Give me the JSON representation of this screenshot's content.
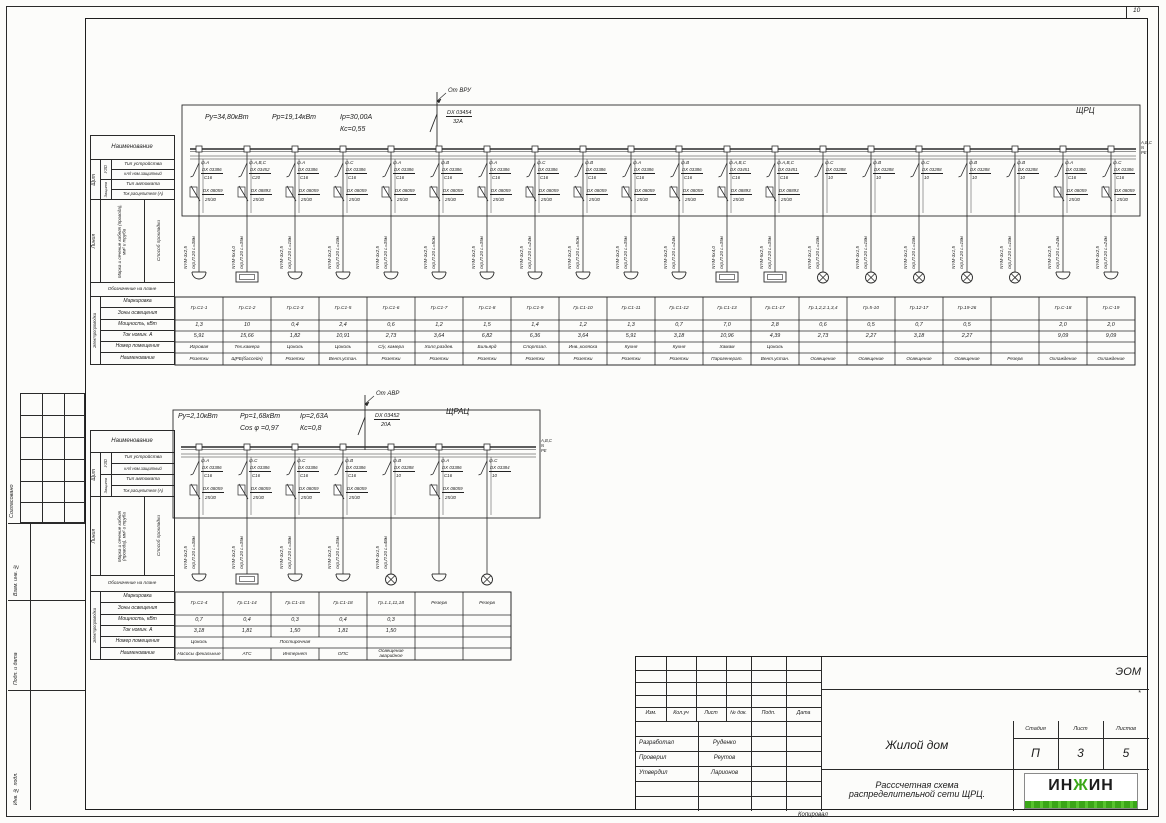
{
  "frame": {
    "zone_number": "10",
    "copied_label": "Копировал",
    "side_labels": [
      "Согласовано",
      "Взам. инв. №",
      "Подп. и дата",
      "Инв. № подл."
    ]
  },
  "colors": {
    "accent_green": "#3aa617",
    "line": "#2a2a2a"
  },
  "row_headers": {
    "name": "Наименование",
    "board": "Щит",
    "uzo": "УЗО",
    "protection": "Защита",
    "device_type": "Тип устройства",
    "ka_rating": "кА/I ном.защитный",
    "breaker_type": "Тип автомата",
    "trip_current": "Ток расцепителя (А)",
    "line": "Линия",
    "cable_mark": "Марка и сечение кабеля (провода), мм² и труба",
    "laying_method": "Способ прокладки",
    "plan_symbol": "Обозначение на плане",
    "wiring": "Электропроводка",
    "marking": "Маркировка",
    "lighting_zones": "Зоны освещения",
    "power": "Мощность, кВт",
    "current": "Ток номин. А",
    "room_number": "Номер помещения",
    "name2": "Наименование"
  },
  "panel1": {
    "title": "ЩРЦ",
    "source": "От ВРУ",
    "incoming_device": "DX  03454",
    "incoming_rating": "32А",
    "params_row1": [
      "Ру=34,80кВт",
      "Рр=19,14кВт",
      "Iр=30,00А"
    ],
    "params_row2": [
      "Кс=0,55"
    ],
    "bus_labels": [
      "А,В,С",
      "N",
      "PE"
    ],
    "circuits": [
      {
        "phase": "ф.А",
        "device": "DX 03386",
        "curve": "С16",
        "rcd": "DX 08059",
        "rcd_rating": "25/30",
        "cable": "NYM-3x2,5",
        "route": "скр,П.20 L=38м",
        "symbol": "socket",
        "group": "Гр.С1-1",
        "power": "1,3",
        "current": "5,91",
        "room": "Игровая",
        "name": "Розетки"
      },
      {
        "phase": "ф.А,В,С",
        "device": "DX 03452",
        "curve": "С20",
        "rcd": "DX 08893",
        "rcd_rating": "25/30",
        "cable": "NYM-5x4,0",
        "route": "скр,П.20 L=35м",
        "symbol": "box",
        "group": "Гр.С1-2",
        "power": "10",
        "current": "15,66",
        "room": "Тех.камера",
        "name": "ЩРБ(бассейн)"
      },
      {
        "phase": "ф.А",
        "device": "DX 03386",
        "curve": "С16",
        "rcd": "DX 08059",
        "rcd_rating": "25/30",
        "cable": "NYM-3x2,5",
        "route": "скр,П.20 L=18м",
        "symbol": "socket",
        "group": "Гр.С1-3",
        "power": "0,4",
        "current": "1,82",
        "room": "Цоколь",
        "name": "Розетки"
      },
      {
        "phase": "ф.С",
        "device": "DX 03386",
        "curve": "С16",
        "rcd": "DX 08059",
        "rcd_rating": "25/30",
        "cable": "NYM-3x2,5",
        "route": "скр,П.20 L=18м",
        "symbol": "socket",
        "group": "Гр.С1-5",
        "power": "2,4",
        "current": "10,91",
        "room": "Цоколь",
        "name": "Вент.устан."
      },
      {
        "phase": "ф.А",
        "device": "DX 03386",
        "curve": "С16",
        "rcd": "DX 08059",
        "rcd_rating": "25/30",
        "cable": "NYM-3x2,5",
        "route": "скр,П.20 L=35м",
        "symbol": "socket",
        "group": "Гр.С1-6",
        "power": "0,6",
        "current": "2,73",
        "room": "С/у, камера",
        "name": "Розетки"
      },
      {
        "phase": "ф.В",
        "device": "DX 03386",
        "curve": "С16",
        "rcd": "DX 08059",
        "rcd_rating": "25/30",
        "cable": "NYM-3x2,5",
        "route": "скр,П.20 L=50м",
        "symbol": "socket",
        "group": "Гр.С1-7",
        "power": "1,2",
        "current": "3,64",
        "room": "Холл,раздев.",
        "name": "Розетки"
      },
      {
        "phase": "ф.А",
        "device": "DX 03386",
        "curve": "С16",
        "rcd": "DX 08059",
        "rcd_rating": "25/30",
        "cable": "NYM-3x2,5",
        "route": "скр,П.20 L=35м",
        "symbol": "socket",
        "group": "Гр.С1-8",
        "power": "1,5",
        "current": "6,82",
        "room": "Бильярд",
        "name": "Розетки"
      },
      {
        "phase": "ф.С",
        "device": "DX 03386",
        "curve": "С16",
        "rcd": "DX 08059",
        "rcd_rating": "25/30",
        "cable": "NYM-3x2,5",
        "route": "скр,П.20 L=24м",
        "symbol": "socket",
        "group": "Гр.С1-9",
        "power": "1,4",
        "current": "6,36",
        "room": "Спортзал.",
        "name": "Розетки"
      },
      {
        "phase": "ф.В",
        "device": "DX 03386",
        "curve": "С16",
        "rcd": "DX 08059",
        "rcd_rating": "25/30",
        "cable": "NYM-3x2,5",
        "route": "скр,П.20 L=50м",
        "symbol": "socket",
        "group": "Гр.С1-10",
        "power": "1,2",
        "current": "3,64",
        "room": "Инв.,коляска",
        "name": "Розетки"
      },
      {
        "phase": "ф.А",
        "device": "DX 03386",
        "curve": "С16",
        "rcd": "DX 08059",
        "rcd_rating": "25/30",
        "cable": "NYM-3x2,5",
        "route": "скр,П.20 L=35м",
        "symbol": "socket",
        "group": "Гр.С1-11",
        "power": "1,3",
        "current": "5,91",
        "room": "Кухня",
        "name": "Розетки"
      },
      {
        "phase": "ф.В",
        "device": "DX 03386",
        "curve": "С16",
        "rcd": "DX 08059",
        "rcd_rating": "25/30",
        "cable": "NYM-3x2,5",
        "route": "скр,П.20 L=24м",
        "symbol": "socket",
        "group": "Гр.С1-12",
        "power": "0,7",
        "current": "3,18",
        "room": "Кухня",
        "name": "Розетки"
      },
      {
        "phase": "ф.А,В,С",
        "device": "DX 03451",
        "curve": "С16",
        "rcd": "DX 08893",
        "rcd_rating": "25/30",
        "cable": "NYM-5x4,0",
        "route": "скр,П.20 L=35м",
        "symbol": "box",
        "group": "Гр.С1-13",
        "power": "7,0",
        "current": "10,96",
        "room": "Хамам",
        "name": "Парогенерат."
      },
      {
        "phase": "ф.А,В,С",
        "device": "DX 03451",
        "curve": "С16",
        "rcd": "DX 08893",
        "rcd_rating": "25/30",
        "cable": "NYM-5x2,5",
        "route": "скр,П.20 L=35м",
        "symbol": "box",
        "group": "Гр.С1-17",
        "power": "2,8",
        "current": "4,39",
        "room": "Цоколь",
        "name": "Вент.устан."
      },
      {
        "phase": "ф.С",
        "device": "DX 03288",
        "curve": "10",
        "cable": "NYM-3x1,5",
        "route": "скр,П.20 L=18м",
        "symbol": "lamp",
        "group": "Гр.1,2,2.1,3,4",
        "power": "0,6",
        "current": "2,73",
        "room": "",
        "name": "Освещение"
      },
      {
        "phase": "ф.В",
        "device": "DX 03288",
        "curve": "10",
        "cable": "NYM-3x1,5",
        "route": "скр,П.20 L=18м",
        "symbol": "lamp",
        "group": "Гр.5-10",
        "power": "0,5",
        "current": "2,27",
        "room": "",
        "name": "Освещение"
      },
      {
        "phase": "ф.С",
        "device": "DX 03288",
        "curve": "10",
        "cable": "NYM-3x1,5",
        "route": "скр,П.20 L=18м",
        "symbol": "lamp",
        "group": "Гр.12-17",
        "power": "0,7",
        "current": "3,18",
        "room": "",
        "name": "Освещение"
      },
      {
        "phase": "ф.В",
        "device": "DX 03288",
        "curve": "10",
        "cable": "NYM-3x1,5",
        "route": "скр,П.20 L=18м",
        "symbol": "lamp",
        "group": "Гр.19-26",
        "power": "0,5",
        "current": "2,27",
        "room": "",
        "name": "Освещение"
      },
      {
        "phase": "ф.В",
        "device": "DX 03288",
        "curve": "10",
        "cable": "NYM-3x1,5",
        "route": "скр,П.20 L=18м",
        "symbol": "lamp",
        "group": "",
        "power": "",
        "current": "",
        "room": "",
        "name": "Резерв"
      },
      {
        "phase": "ф.А",
        "device": "DX 03386",
        "curve": "С16",
        "rcd": "DX 08059",
        "rcd_rating": "25/30",
        "cable": "NYM-3x2,5",
        "route": "скр,П.20 L=24м",
        "symbol": "socket",
        "group": "Гр.С-18",
        "power": "2,0",
        "current": "9,09",
        "room": "",
        "name": "Охлаждение"
      },
      {
        "phase": "ф.С",
        "device": "DX 03386",
        "curve": "С16",
        "rcd": "DX 08059",
        "rcd_rating": "25/30",
        "cable": "NYM-3x2,5",
        "route": "скр,П.20 L=24м",
        "symbol": "socket",
        "group": "Гр.С-19",
        "power": "2,0",
        "current": "9,09",
        "room": "",
        "name": "Охлаждение"
      }
    ]
  },
  "panel2": {
    "title": "ЩРАЦ",
    "source": "От АВР",
    "incoming_device": "DX  03452",
    "incoming_rating": "20А",
    "params_row1": [
      "Ру=2,10кВт",
      "Рр=1,68кВт",
      "Iр=2,63А"
    ],
    "params_row2": [
      "Cos φ =0,97",
      "Кс=0,8"
    ],
    "bus_labels": [
      "А,В,С",
      "N",
      "PE"
    ],
    "circuits": [
      {
        "phase": "ф.А",
        "device": "DX 03386",
        "curve": "С16",
        "rcd": "DX 08059",
        "rcd_rating": "25/30",
        "cable": "NYM-3x2,5",
        "route": "скр,П.20 L=38м",
        "symbol": "socket",
        "group": "Гр.С1-4",
        "power": "0,7",
        "current": "3,18",
        "room": "Цоколь",
        "name": "Насосы фекальные"
      },
      {
        "phase": "ф.С",
        "device": "DX 03386",
        "curve": "С16",
        "rcd": "DX 08059",
        "rcd_rating": "25/30",
        "cable": "NYM-3x2,5",
        "route": "скр,П.20 L=35м",
        "symbol": "box",
        "group": "Гр.С1-14",
        "power": "0,4",
        "current": "1,81",
        "room": "Постирочная",
        "room_span": 3,
        "name": "АТС"
      },
      {
        "phase": "ф.С",
        "device": "DX 03386",
        "curve": "С16",
        "rcd": "DX 08059",
        "rcd_rating": "25/30",
        "cable": "NYM-3x2,5",
        "route": "скр,П.20 L=38м",
        "symbol": "socket",
        "group": "Гр.С1-15",
        "power": "0,3",
        "current": "1,50",
        "room": "",
        "name": "Интернет"
      },
      {
        "phase": "ф.В",
        "device": "DX 03386",
        "curve": "С16",
        "rcd": "DX 08059",
        "rcd_rating": "25/30",
        "cable": "NYM-3x2,5",
        "route": "скр,П.20 L=35м",
        "symbol": "socket",
        "group": "Гр.С1-18",
        "power": "0,4",
        "current": "1,81",
        "room": "",
        "name": "ОПС"
      },
      {
        "phase": "ф.В",
        "device": "DX 03288",
        "curve": "10",
        "cable": "NYM-3x1,5",
        "route": "скр,П.20 L=48м",
        "symbol": "lamp",
        "group": "Гр.1.1,11,18",
        "power": "0,3",
        "current": "1,50",
        "room": "",
        "name": "Освещение аварийное"
      },
      {
        "phase": "ф.А",
        "device": "DX 03386",
        "curve": "С16",
        "rcd": "DX 08059",
        "rcd_rating": "25/30",
        "symbol": "socket",
        "group": "Резерв",
        "power": "",
        "current": "",
        "room": "",
        "name": ""
      },
      {
        "phase": "ф.С",
        "device": "DX 03384",
        "curve": "10",
        "symbol": "lamp",
        "group": "Резерв",
        "power": "",
        "current": "",
        "room": "",
        "name": ""
      }
    ]
  },
  "titleblock": {
    "doc_code": "ЭОМ",
    "asterisk": "*",
    "header_cols": [
      "Изм.",
      "Кол.уч",
      "Лист",
      "№ док.",
      "Подп.",
      "Дата"
    ],
    "sig_rows": [
      {
        "role": "Разработал",
        "name": "Руденко"
      },
      {
        "role": "Проверил",
        "name": "Реутов"
      },
      {
        "role": "Утвердил",
        "name": "Ларионов"
      }
    ],
    "project": "Жилой дом",
    "doc_title_line1": "Расссчетная схема",
    "doc_title_line2": "распределительной сети  ЩРЦ.",
    "stage_label": "Стадия",
    "sheet_label": "Лист",
    "sheets_label": "Листов",
    "stage": "П",
    "sheet": "3",
    "sheets": "5",
    "logo_text": "ИНЖИН"
  }
}
